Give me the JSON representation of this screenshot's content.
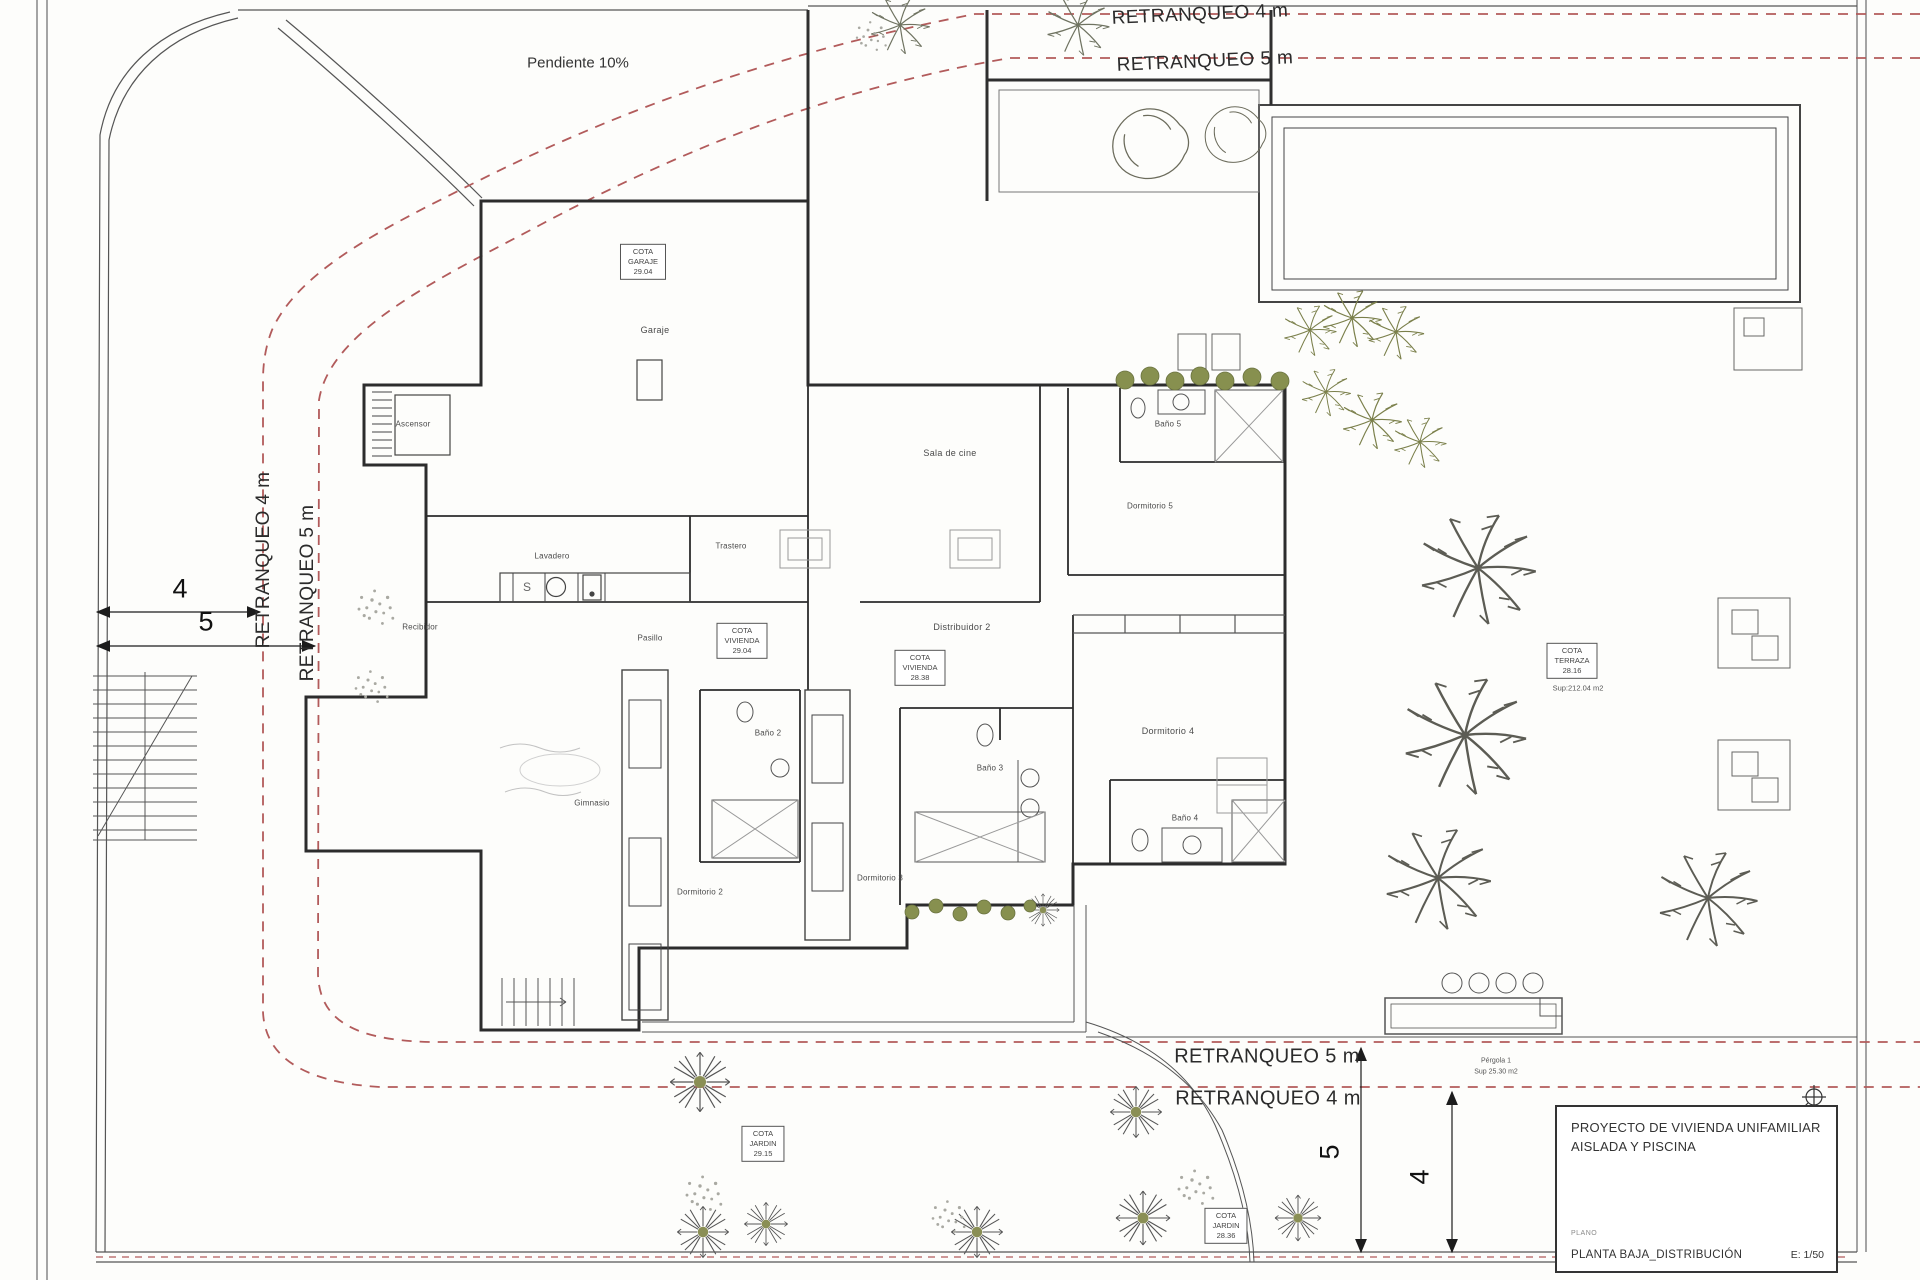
{
  "plan": {
    "pendiente": "Pendiente 10%",
    "retranqueo": {
      "top4": "RETRANQUEO 4 m",
      "top5": "RETRANQUEO 5 m",
      "left4": "RETRANQUEO 4 m",
      "left5": "RETRANQUEO 5 m",
      "bottom5": "RETRANQUEO 5 m",
      "bottom4": "RETRANQUEO 4 m"
    },
    "dims": {
      "left4": "4",
      "left5": "5",
      "bottom5": "5",
      "bottom4": "4"
    },
    "rooms": {
      "ascensor": "Ascensor",
      "garaje": "Garaje",
      "lavadero": "Lavadero",
      "trastero": "Trastero",
      "recibidor": "Recibidor",
      "pasillo": "Pasillo",
      "sala_de_cine": "Sala de cine",
      "distribuidor2": "Distribuidor 2",
      "bano5": "Baño 5",
      "dormitorio5": "Dormitorio 5",
      "dormitorio4": "Dormitorio 4",
      "bano4": "Baño 4",
      "bano3": "Baño 3",
      "dormitorio3": "Dormitorio 3",
      "dormitorio2": "Dormitorio 2",
      "bano2": "Baño 2",
      "gimnasio": "Gimnasio"
    },
    "cotas": {
      "garaje": {
        "t": "COTA",
        "m": "GARAJE",
        "v": "29.04"
      },
      "vivienda1": {
        "t": "COTA",
        "m": "VIVIENDA",
        "v": "29.04"
      },
      "vivienda2": {
        "t": "COTA",
        "m": "VIVIENDA",
        "v": "28.38"
      },
      "terraza": {
        "t": "COTA",
        "m": "TERRAZA",
        "v": "28.16",
        "sup": "Sup:212.04 m2"
      },
      "jardin1": {
        "t": "COTA",
        "m": "JARDIN",
        "v": "29.15"
      },
      "jardin2": {
        "t": "COTA",
        "m": "JARDIN",
        "v": "28.36"
      }
    },
    "pergola": {
      "name": "Pérgola 1",
      "sup": "Sup 25.30 m2"
    },
    "sink_letter": "S"
  },
  "title_block": {
    "project1": "PROYECTO  DE VIVIENDA UNIFAMILIAR",
    "project2": "AISLADA Y PISCINA",
    "plano_label": "PLANO",
    "sheet": "PLANTA BAJA_DISTRIBUCIÓN",
    "scale": "E: 1/50"
  }
}
